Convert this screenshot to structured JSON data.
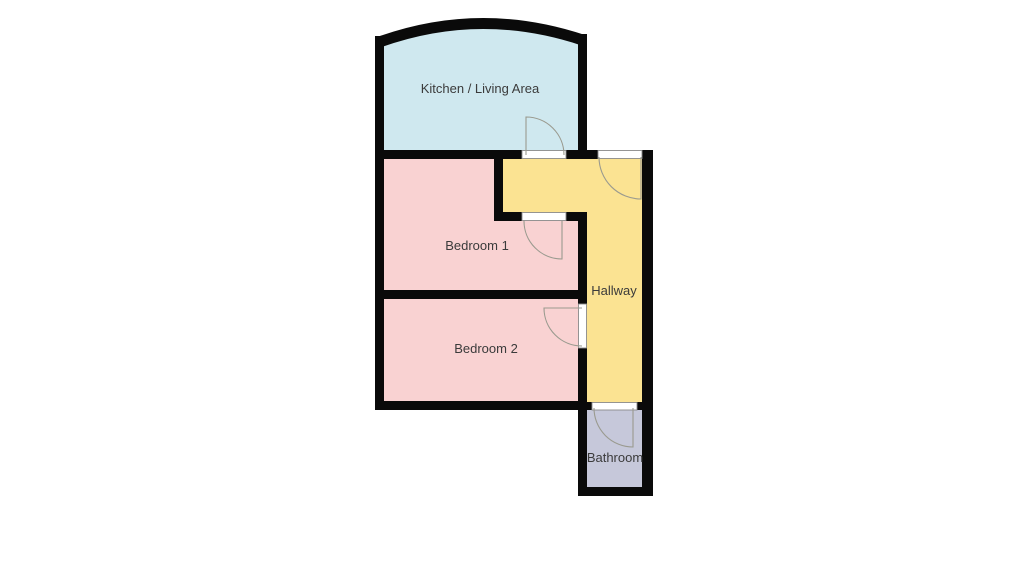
{
  "floor_plan": {
    "background_color": "#ffffff",
    "wall_color": "#0a0a0a",
    "door_frame_fill": "#ffffff",
    "door_frame_border": "#8a8a8a",
    "door_swing_color": "#9a9a8f",
    "label_color": "#3b3b3b",
    "rooms": [
      {
        "id": "kitchen-living-area",
        "label": "Kitchen / Living Area",
        "color": "#cfe8ef",
        "label_x": 480,
        "label_y": 93
      },
      {
        "id": "bedroom-1",
        "label": "Bedroom 1",
        "color": "#f9d2d2",
        "label_x": 477,
        "label_y": 250
      },
      {
        "id": "bedroom-2",
        "label": "Bedroom 2",
        "color": "#f9d2d2",
        "label_x": 486,
        "label_y": 353
      },
      {
        "id": "hallway",
        "label": "Hallway",
        "color": "#fbe392",
        "label_x": 614,
        "label_y": 295
      },
      {
        "id": "bathroom",
        "label": "Bathroom",
        "color": "#c6c8da",
        "label_x": 615,
        "label_y": 462
      }
    ],
    "doors": [
      {
        "id": "kitchen-door",
        "connects": "Kitchen / Living Area - Hallway"
      },
      {
        "id": "entry-door",
        "connects": "Outside - Hallway"
      },
      {
        "id": "bedroom-1-door",
        "connects": "Hallway - Bedroom 1"
      },
      {
        "id": "bedroom-2-door",
        "connects": "Hallway - Bedroom 2"
      },
      {
        "id": "bathroom-door",
        "connects": "Hallway - Bathroom"
      }
    ]
  }
}
